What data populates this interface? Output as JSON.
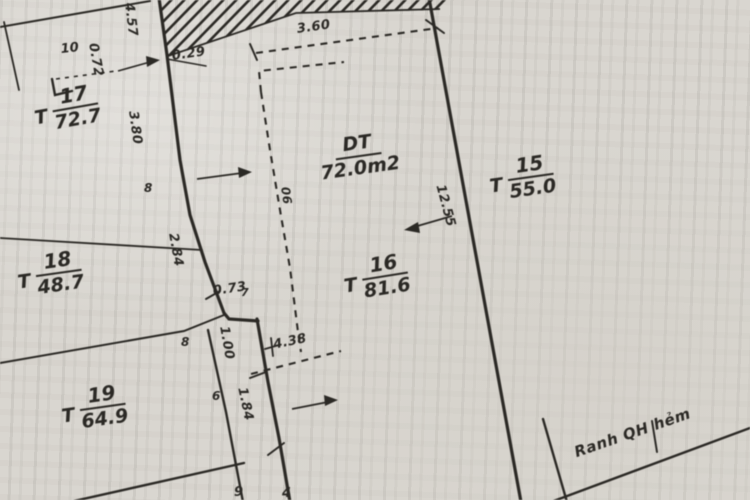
{
  "map": {
    "kind": "cadastral-plot-sketch",
    "colors": {
      "ink": "#2a2824",
      "paper": "#d9d6d0"
    },
    "plots": {
      "t17": {
        "prefix": "T",
        "number": "17",
        "area": "72.7"
      },
      "t18": {
        "prefix": "T",
        "number": "18",
        "area": "48.7"
      },
      "t19": {
        "prefix": "T",
        "number": "19",
        "area": "64.9"
      },
      "t16": {
        "prefix": "T",
        "number": "16",
        "area": "81.6"
      },
      "t15": {
        "prefix": "T",
        "number": "15",
        "area": "55.0"
      },
      "subject": {
        "label": "DT",
        "area": "72.0m2"
      }
    },
    "dimensions": {
      "d457": "4.57",
      "d072": "0.72",
      "d029": "0.29",
      "d360": "3.60",
      "d380": "3.80",
      "d284": "2.84",
      "d073": "0.73",
      "d438": "4.38",
      "d100": "1.00",
      "d184": "1.84",
      "d1255": "12.55",
      "d06": "06"
    },
    "points": {
      "p10": "10",
      "p8_upper": "8",
      "p8_lower": "8",
      "p7": "7",
      "p6": "6",
      "p9": "9",
      "p4": "4"
    },
    "notes": {
      "ranh_qh_hem": "Ranh QH hẻm"
    }
  }
}
